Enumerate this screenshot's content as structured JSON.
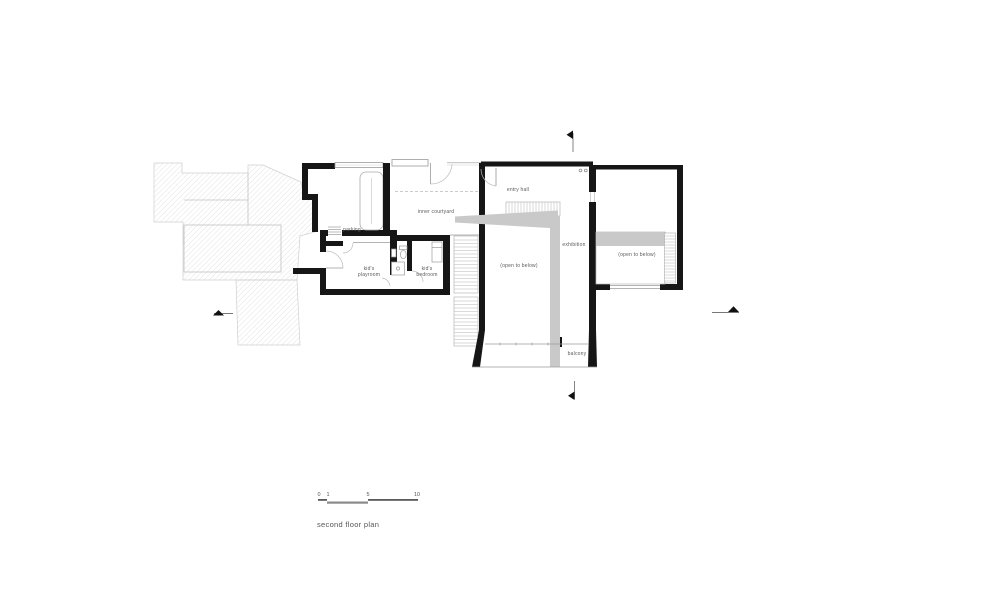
{
  "drawing": {
    "title": "second floor plan",
    "rooms": {
      "entry_hall": "entry hall",
      "inner_courtyard": "inner courtyard",
      "parking": "parking",
      "kids_playroom": "kid's playroom",
      "kids_bedroom": "kid's bedroom",
      "exhibition": "exhibition",
      "open_to_below_main": "(open to below)",
      "open_to_below_gallery": "(open to below)",
      "balcony": "balcony"
    },
    "scale_bar": {
      "ticks": [
        "0",
        "1",
        "5",
        "10"
      ]
    },
    "colors": {
      "wall": "#161616",
      "thin_line": "#9a9a9a",
      "gray_fill": "#c9c9c9",
      "hatch_line": "#d9d9d9",
      "text": "#555555"
    }
  }
}
